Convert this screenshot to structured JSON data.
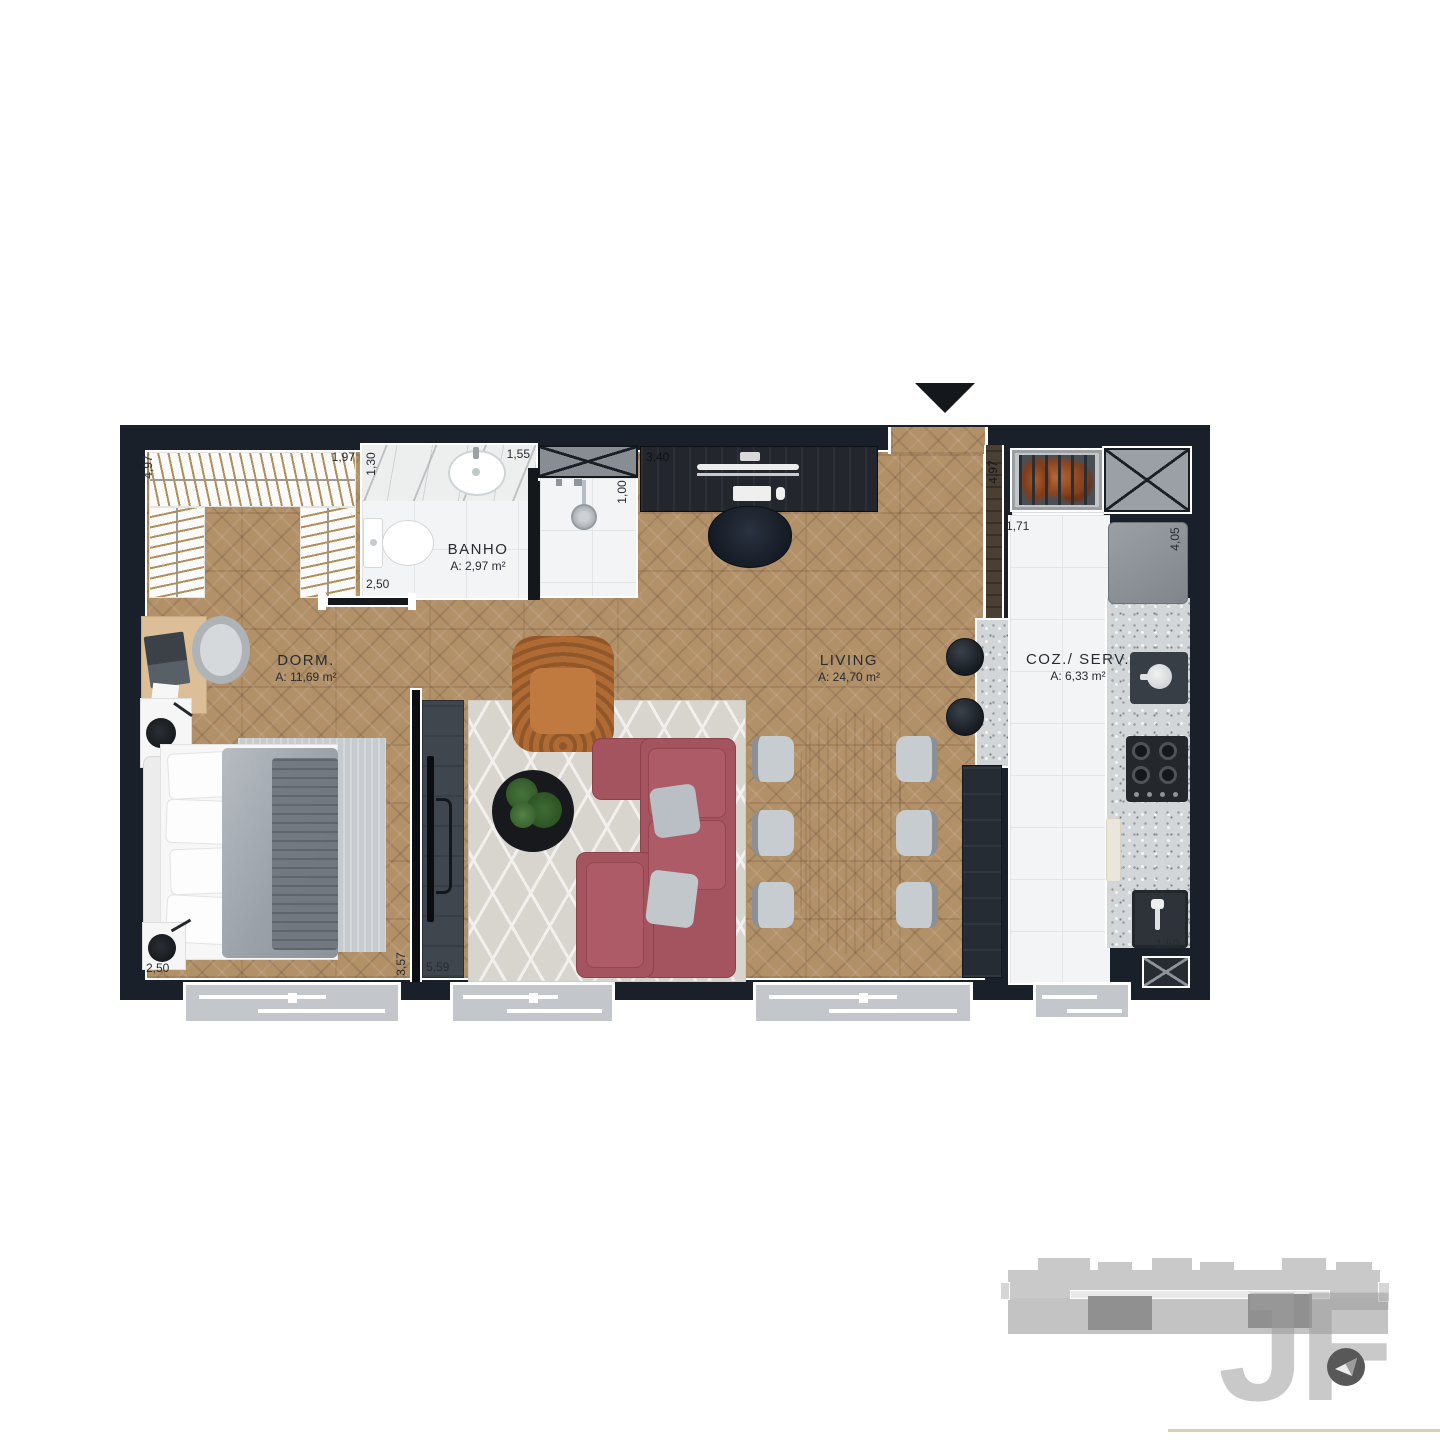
{
  "plan": {
    "rooms": {
      "dorm": {
        "label": "DORM.",
        "area": "A: 11,69 m²"
      },
      "bath": {
        "label": "BANHO",
        "area": "A: 2,97 m²"
      },
      "living": {
        "label": "LIVING",
        "area": "A: 24,70 m²"
      },
      "kitchen": {
        "label": "COZ./ SERV.",
        "area": "A: 6,33 m²"
      }
    },
    "dims": {
      "closet_left": "4,97",
      "closet_top": "1,97",
      "bath_left": "1,30",
      "bath_top": "1,55",
      "bath_bottom": "2,50",
      "shower": "1,00",
      "desk": "3,40",
      "entry_panel": "4,97",
      "kitchen_top": "1,71",
      "kitchen_right": "4,05",
      "kitchen_bottom": "1,50",
      "dorm_bottom": "2,50",
      "dorm_right": "3,57",
      "living_bottom": "5,59"
    },
    "colors": {
      "wall": "#1a202a",
      "wood_floor": "#b29068",
      "sofa": "#a4545e",
      "armchair_leather": "#b06a33",
      "counter": "#d3d6d8",
      "footer_rule": "#d9cfab"
    },
    "icons": {
      "entry_marker": "triangle-down",
      "compass": "north-arrow",
      "shaft": "crossed-box"
    }
  },
  "branding": {
    "watermark": "JF"
  }
}
